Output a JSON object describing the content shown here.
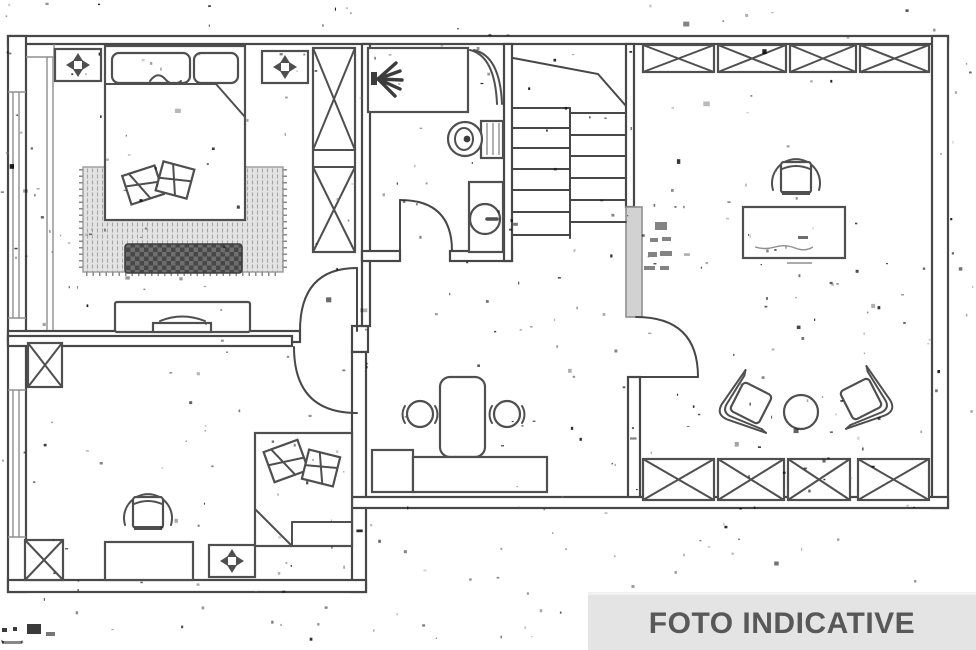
{
  "banner": {
    "label": "FOTO INDICATIVE"
  },
  "colors": {
    "wall": "#474747",
    "furn": "#4f4f4f",
    "light": "#8f8f8f",
    "gray_band": "#d2d2d2",
    "rug_bg": "#e3e3e3",
    "bench": "#474747",
    "banner_bg": "#e4e4e4",
    "banner_text": "#585858"
  },
  "plan": {
    "type": "apartment-floor-plan",
    "rooms": [
      {
        "name": "bedroom-1",
        "furniture": [
          "double-bed",
          "pillows",
          "rug",
          "bench",
          "wardrobe",
          "dresser",
          "ceiling-light",
          "ceiling-light"
        ]
      },
      {
        "name": "bathroom",
        "furniture": [
          "shower",
          "toilet",
          "washbasin"
        ]
      },
      {
        "name": "staircase",
        "furniture": [
          "stair-treads"
        ]
      },
      {
        "name": "bedroom-2",
        "furniture": [
          "single-bed",
          "pillows",
          "desk",
          "desk-chair",
          "storage-box",
          "storage-box",
          "ceiling-light"
        ]
      },
      {
        "name": "hall-dining",
        "furniture": [
          "dining-table",
          "stool",
          "stool",
          "counter"
        ]
      },
      {
        "name": "living-room",
        "furniture": [
          "wardrobe-strip-top",
          "wardrobe-strip-bottom",
          "desk",
          "desk-chair",
          "armchair",
          "armchair",
          "round-table"
        ]
      }
    ]
  }
}
